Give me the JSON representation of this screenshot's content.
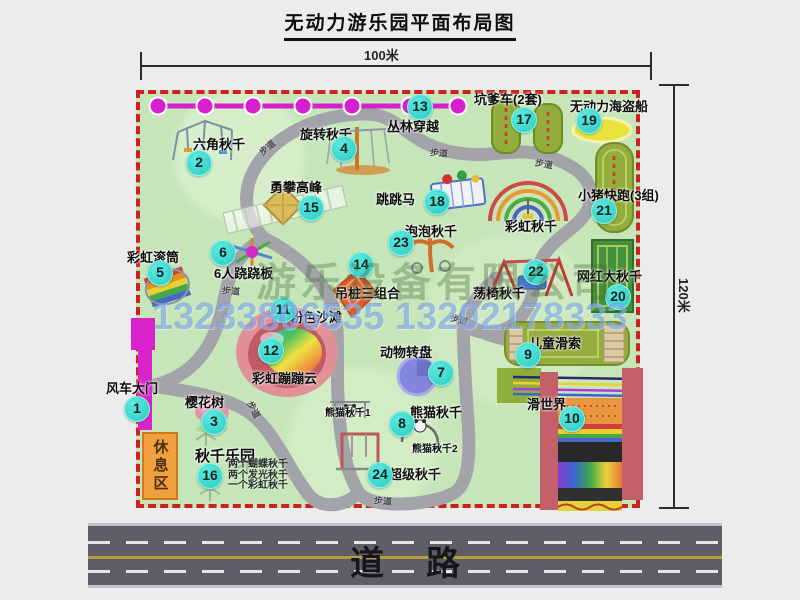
{
  "title": "无动力游乐园平面布局图",
  "dimensions": {
    "width_label": "100米",
    "height_label": "120米"
  },
  "watermarks": {
    "company": "游乐设备有限公司",
    "phone": "13233806535 13202178333"
  },
  "road": {
    "label": "道路"
  },
  "rest_area": {
    "label": "休息区"
  },
  "colors": {
    "park_green": "#c6e6ba",
    "border_red": "#cf1f1f",
    "marker_cyan": "#2bccc2",
    "jungle_magenta": "#d81fd0",
    "road_gray": "#5e5e66",
    "rest_orange": "#f0a03c"
  },
  "map": {
    "markers": [
      {
        "n": "1",
        "x": 137,
        "y": 409
      },
      {
        "n": "2",
        "x": 199,
        "y": 163
      },
      {
        "n": "3",
        "x": 214,
        "y": 422
      },
      {
        "n": "4",
        "x": 344,
        "y": 149
      },
      {
        "n": "5",
        "x": 160,
        "y": 273
      },
      {
        "n": "6",
        "x": 223,
        "y": 253
      },
      {
        "n": "7",
        "x": 441,
        "y": 373
      },
      {
        "n": "8",
        "x": 402,
        "y": 424
      },
      {
        "n": "9",
        "x": 528,
        "y": 355
      },
      {
        "n": "10",
        "x": 572,
        "y": 419
      },
      {
        "n": "11",
        "x": 283,
        "y": 310
      },
      {
        "n": "12",
        "x": 271,
        "y": 351
      },
      {
        "n": "13",
        "x": 420,
        "y": 107
      },
      {
        "n": "14",
        "x": 361,
        "y": 265
      },
      {
        "n": "15",
        "x": 311,
        "y": 208
      },
      {
        "n": "16",
        "x": 210,
        "y": 476
      },
      {
        "n": "17",
        "x": 524,
        "y": 120
      },
      {
        "n": "18",
        "x": 437,
        "y": 202
      },
      {
        "n": "19",
        "x": 589,
        "y": 121
      },
      {
        "n": "20",
        "x": 618,
        "y": 297
      },
      {
        "n": "21",
        "x": 604,
        "y": 211
      },
      {
        "n": "22",
        "x": 536,
        "y": 272
      },
      {
        "n": "23",
        "x": 401,
        "y": 243
      },
      {
        "n": "24",
        "x": 380,
        "y": 475
      }
    ],
    "labels": [
      {
        "t": "丛林穿越",
        "x": 387,
        "y": 116
      },
      {
        "t": "六角秋千",
        "x": 193,
        "y": 134
      },
      {
        "t": "旋转秋千",
        "x": 300,
        "y": 124
      },
      {
        "t": "勇攀高峰",
        "x": 270,
        "y": 177
      },
      {
        "t": "跳跳马",
        "x": 376,
        "y": 189
      },
      {
        "t": "坑爹车(2套)",
        "x": 474,
        "y": 89
      },
      {
        "t": "无动力海盗船",
        "x": 570,
        "y": 96
      },
      {
        "t": "小猪快跑(3组)",
        "x": 578,
        "y": 185
      },
      {
        "t": "彩虹秋千",
        "x": 505,
        "y": 216
      },
      {
        "t": "泡泡秋千",
        "x": 405,
        "y": 221
      },
      {
        "t": "彩虹滚筒",
        "x": 127,
        "y": 247
      },
      {
        "t": "6人跷跷板",
        "x": 214,
        "y": 263
      },
      {
        "t": "吊桩三组合",
        "x": 335,
        "y": 283
      },
      {
        "t": "荡椅秋千",
        "x": 473,
        "y": 283
      },
      {
        "t": "网红大秋千",
        "x": 577,
        "y": 266
      },
      {
        "t": "粉色沙滩",
        "x": 290,
        "y": 307
      },
      {
        "t": "彩虹蹦蹦云",
        "x": 252,
        "y": 368
      },
      {
        "t": "动物转盘",
        "x": 380,
        "y": 342
      },
      {
        "t": "儿童滑索",
        "x": 529,
        "y": 333
      },
      {
        "t": "熊猫秋千",
        "x": 410,
        "y": 402
      },
      {
        "t": "熊猫秋千1",
        "x": 325,
        "y": 404,
        "cls": "small"
      },
      {
        "t": "熊猫秋千2",
        "x": 412,
        "y": 440,
        "cls": "small"
      },
      {
        "t": "滑世界",
        "x": 527,
        "y": 394
      },
      {
        "t": "超级秋千",
        "x": 389,
        "y": 464
      },
      {
        "t": "秋千乐园",
        "x": 195,
        "y": 445,
        "cls": "big"
      },
      {
        "t": "风车大门",
        "x": 106,
        "y": 378
      },
      {
        "t": "樱花树",
        "x": 185,
        "y": 392
      }
    ],
    "trail_labels": [
      {
        "t": "步道",
        "x": 258,
        "y": 141,
        "r": -40
      },
      {
        "t": "步道",
        "x": 430,
        "y": 146,
        "r": 5
      },
      {
        "t": "步道",
        "x": 535,
        "y": 157,
        "r": 10
      },
      {
        "t": "步道",
        "x": 222,
        "y": 284,
        "r": 5
      },
      {
        "t": "步道",
        "x": 245,
        "y": 403,
        "r": 62
      },
      {
        "t": "步道",
        "x": 450,
        "y": 313,
        "r": 15
      },
      {
        "t": "步道",
        "x": 374,
        "y": 494,
        "r": 5
      }
    ],
    "swing_park_details": [
      "两个蝴蝶秋千",
      "两个发光秋千",
      "一个彩虹秋千"
    ]
  }
}
